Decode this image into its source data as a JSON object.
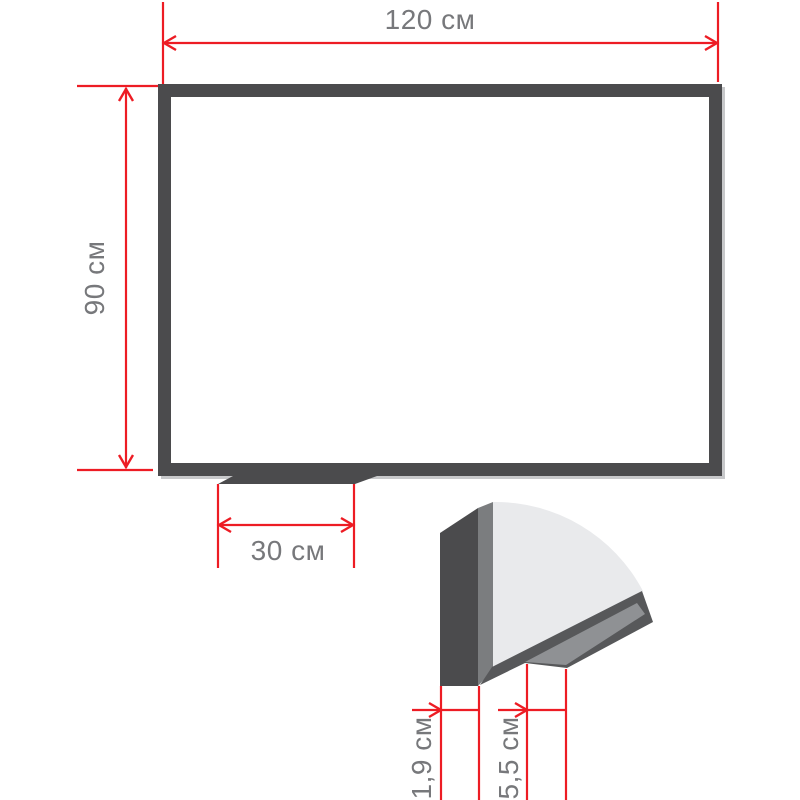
{
  "diagram": {
    "title": "whiteboard-dimensions",
    "width_label": "120 см",
    "height_label": "90 см",
    "tray_width_label": "30 см",
    "frame_depth_label": "1,9 см",
    "tray_depth_label": "5,5 см"
  },
  "colors": {
    "dimension_red": "#ed1c24",
    "frame_dark": "#4b4b4d",
    "frame_side_gray": "#7b7d7f",
    "surface_light": "#e9eaec",
    "band_dark": "#57585a",
    "tray_stripe_gray": "#8f9194",
    "shadow_light": "#c7c8ca",
    "board_white": "#ffffff",
    "label_gray": "#77787b"
  }
}
